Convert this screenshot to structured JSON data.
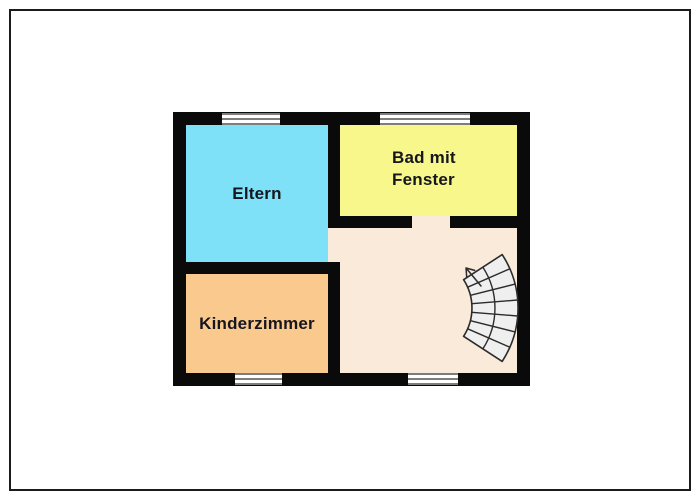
{
  "page": {
    "background": "#ffffff",
    "frame_color": "#1b1b1b"
  },
  "floorplan": {
    "wall_color": "#0a0a0a",
    "label_color": "#16161e",
    "window": {
      "glass_color": "#ffffff",
      "line_color": "#7d7d7d",
      "count": 4
    },
    "rooms": [
      {
        "name": "eltern",
        "label": "Eltern",
        "color": "#7ee1f7"
      },
      {
        "name": "bad",
        "label": "Bad mit Fenster",
        "color": "#f7f78c"
      },
      {
        "name": "kinderzimmer",
        "label": "Kinderzimmer",
        "color": "#f9c98e"
      },
      {
        "name": "flur",
        "label": "",
        "color": "#f9ead9"
      }
    ],
    "stairs": {
      "kind": "curved-staircase",
      "fill": "#efefef",
      "line": "#2b2b2b",
      "direction_arrow": "up"
    }
  }
}
